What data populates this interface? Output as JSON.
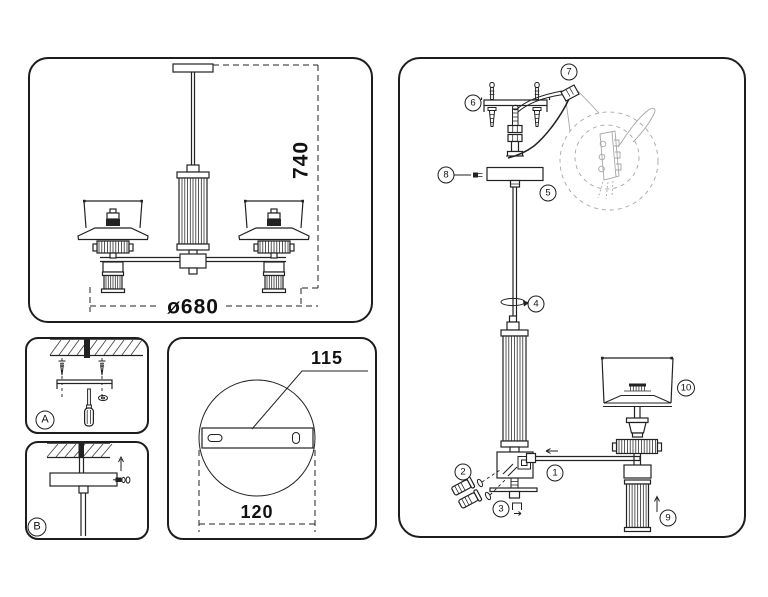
{
  "colors": {
    "line": "#222222",
    "panel_border": "#1d1d1d",
    "background": "#ffffff",
    "detail_gray": "#a6a6a6"
  },
  "panels": {
    "overview": {
      "height_mm": "740",
      "diameter_mm": "ø680"
    },
    "step_a": {
      "label": "A"
    },
    "step_b": {
      "label": "B"
    },
    "mounting_plate": {
      "hole_spacing_mm": "115",
      "plate_width_mm": "120"
    },
    "assembly": {
      "callouts": [
        "1",
        "2",
        "3",
        "4",
        "5",
        "6",
        "7",
        "8",
        "9",
        "10"
      ]
    }
  }
}
